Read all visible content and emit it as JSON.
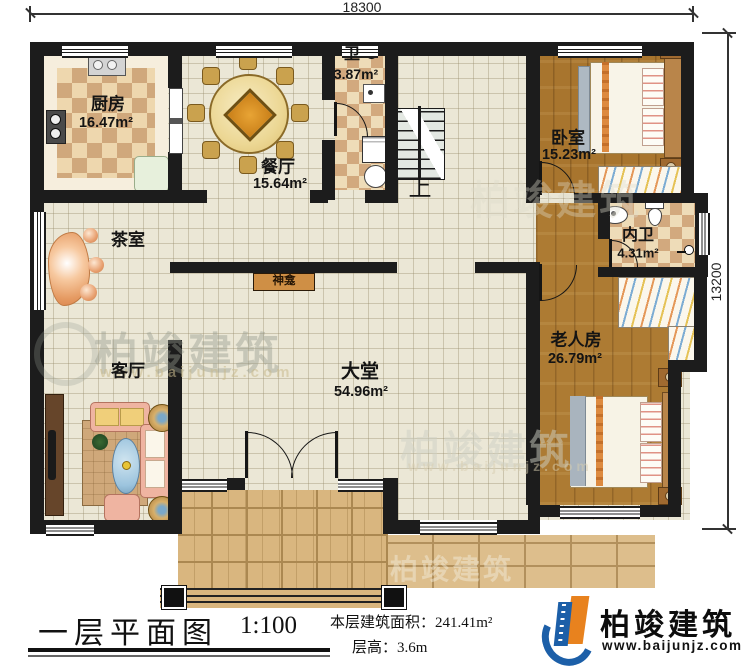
{
  "dimensions": {
    "top_width": "18300",
    "right_height": "13200"
  },
  "rooms": {
    "kitchen": {
      "name": "厨房",
      "area": "16.47m²"
    },
    "dining_room": {
      "name": "餐厅",
      "area": "15.64m²"
    },
    "bathroom": {
      "name": "卫",
      "area": "3.87m²"
    },
    "bedroom": {
      "name": "卧室",
      "area": "15.23m²"
    },
    "ensuite_bathroom": {
      "name": "内卫",
      "area": "4.31m²"
    },
    "elder_room": {
      "name": "老人房",
      "area": "26.79m²"
    },
    "tea_room": {
      "name": "茶室"
    },
    "living_room": {
      "name": "客厅"
    },
    "great_hall": {
      "name": "大堂",
      "area": "54.96m²"
    },
    "shrine": {
      "name": "神龛"
    },
    "stairs": {
      "up_label": "上"
    }
  },
  "title_block": {
    "plan_name": "一层平面图",
    "scale": "1:100",
    "floor_area_label": "本层建筑面积：",
    "floor_area_value": "241.41m²",
    "floor_height_label": "层高：",
    "floor_height_value": "3.6m"
  },
  "brand": {
    "name": "柏竣建筑",
    "website": "www.baijunjz.com",
    "blue": "#1c5fa8",
    "orange": "#e8821e"
  },
  "watermark": {
    "name": "柏竣建筑",
    "website": "www.baijunjz.com"
  }
}
